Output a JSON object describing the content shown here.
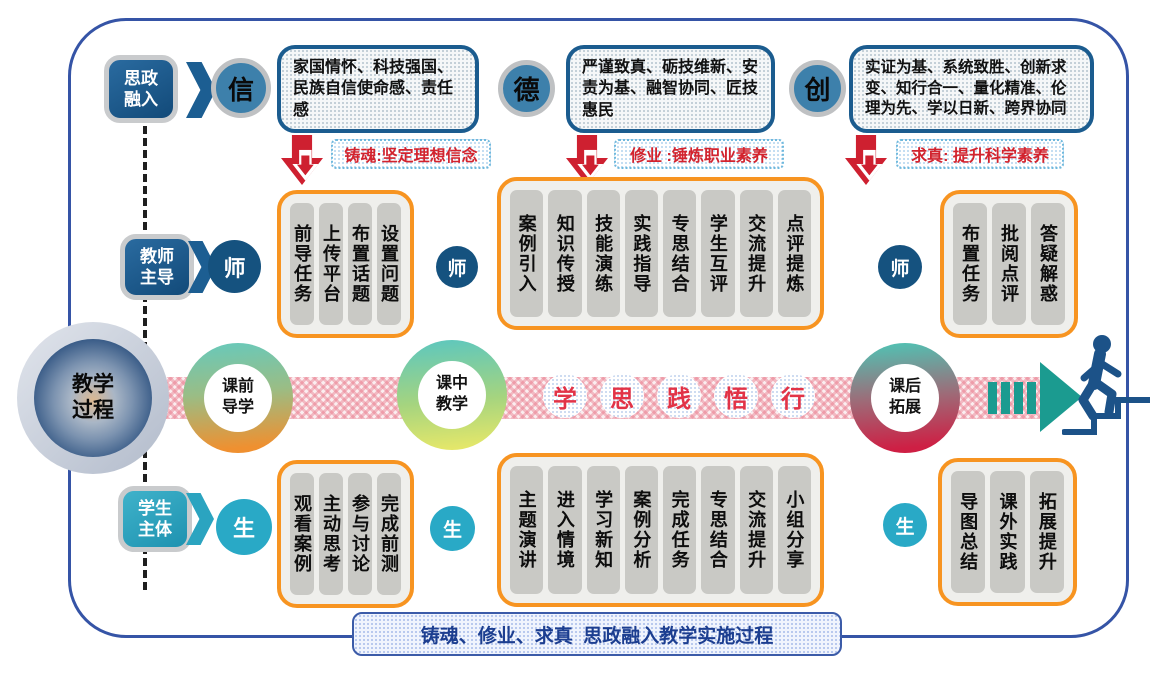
{
  "top": {
    "badge": "思政\n融入",
    "concepts": [
      {
        "letter": "信",
        "text": "家国情怀、科技强国、民族自信使命感、责任感"
      },
      {
        "letter": "德",
        "text": "严谨致真、砺技维新、安责为基、融智协同、匠技惠民"
      },
      {
        "letter": "创",
        "text": "实证为基、系统致胜、创新求变、知行合一、量化精准、伦理为先、学以日新、跨界协同"
      }
    ],
    "labels": [
      "铸魂:坚定理想信念",
      "修业 :锤炼职业素养",
      "求真: 提升科学素养"
    ]
  },
  "teacher": {
    "badge": "教师\n主导",
    "letter": "师",
    "groups": [
      [
        "前导任务",
        "上传平台",
        "布置话题",
        "设置问题"
      ],
      [
        "案例引入",
        "知识传授",
        "技能演练",
        "实践指导",
        "专思结合",
        "学生互评",
        "交流提升",
        "点评提炼"
      ],
      [
        "布置任务",
        "批阅点评",
        "答疑解惑"
      ]
    ]
  },
  "process": {
    "main": "教学\n过程",
    "stages": [
      "课前\n导学",
      "课中\n教学",
      "课后\n拓展"
    ],
    "keywords": [
      "学",
      "思",
      "践",
      "悟",
      "行"
    ]
  },
  "student": {
    "badge": "学生\n主体",
    "letter": "生",
    "groups": [
      [
        "观看案例",
        "主动思考",
        "参与讨论",
        "完成前测"
      ],
      [
        "主题演讲",
        "进入情境",
        "学习新知",
        "案例分析",
        "完成任务",
        "专思结合",
        "交流提升",
        "小组分享"
      ],
      [
        "导图总结",
        "课外实践",
        "拓展提升"
      ]
    ]
  },
  "footer": {
    "banner": "铸魂、修业、求真  思政融入教学实施过程"
  },
  "colors": {
    "accent_orange": "#f79421",
    "navy": "#15527f",
    "steel_blue": "#3d80ab",
    "cyan": "#29a9c6",
    "red": "#ce2030",
    "teal": "#1b9b90",
    "border_blue": "#3554a6"
  }
}
